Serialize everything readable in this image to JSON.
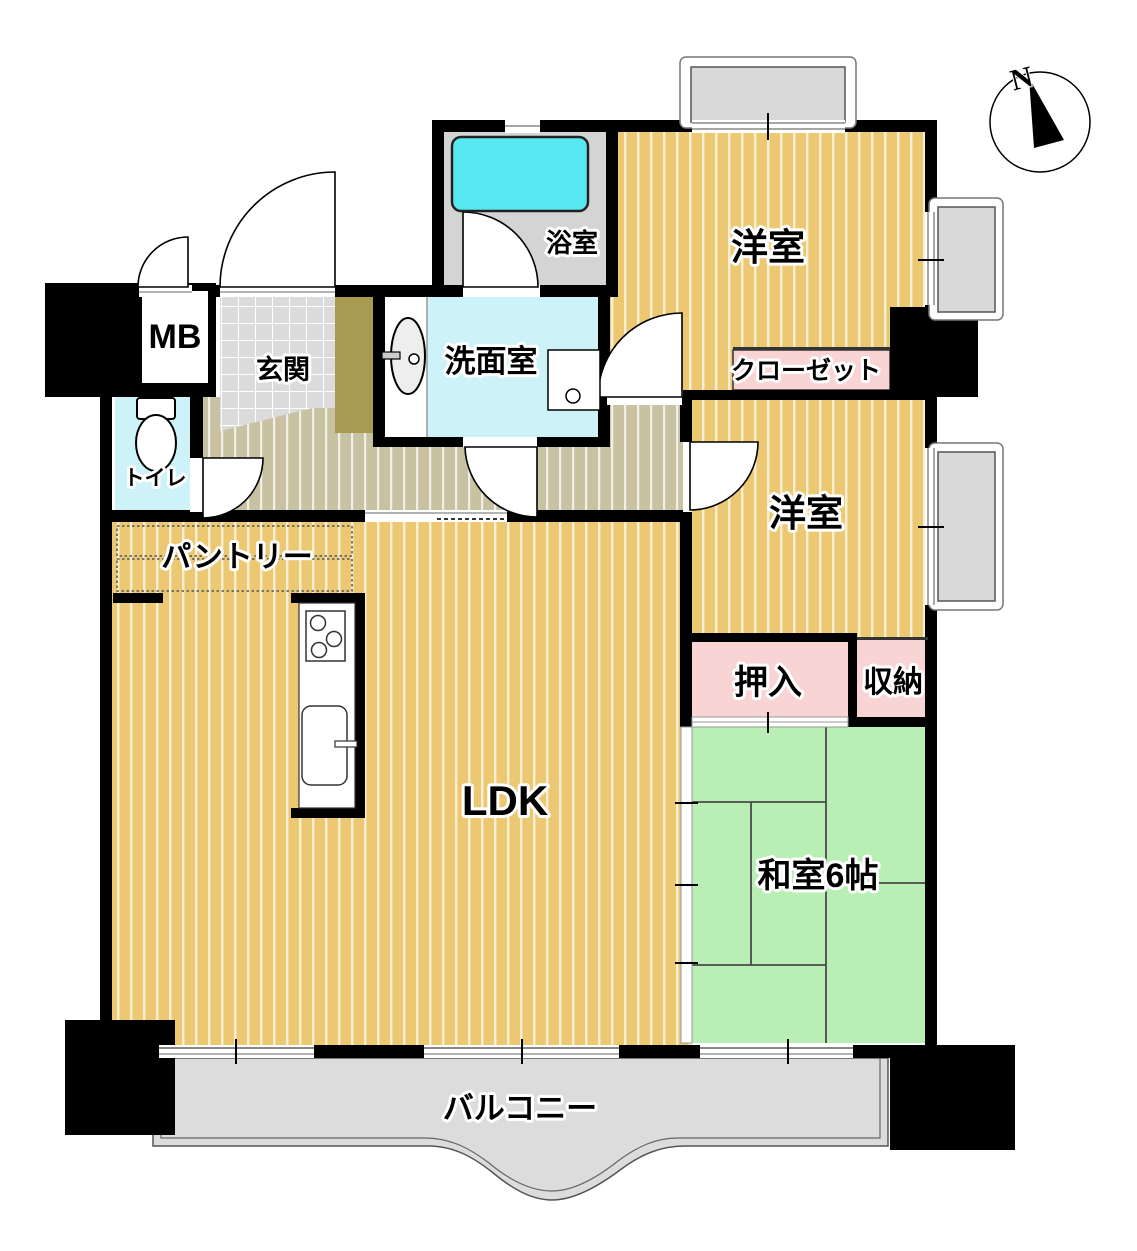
{
  "title": "apartment-floor-plan",
  "compass": {
    "north_label": "N"
  },
  "rooms": [
    {
      "id": "meter-box",
      "label": "MB"
    },
    {
      "id": "entrance",
      "label": "玄関"
    },
    {
      "id": "toilet",
      "label": "トイレ"
    },
    {
      "id": "pantry",
      "label": "パントリー"
    },
    {
      "id": "washroom",
      "label": "洗面室"
    },
    {
      "id": "bathroom",
      "label": "浴室"
    },
    {
      "id": "western-room-1",
      "label": "洋室"
    },
    {
      "id": "closet",
      "label": "クローゼット"
    },
    {
      "id": "western-room-2",
      "label": "洋室"
    },
    {
      "id": "oshiire",
      "label": "押入"
    },
    {
      "id": "storage",
      "label": "収納"
    },
    {
      "id": "japanese-room",
      "label": "和室6帖"
    },
    {
      "id": "ldk",
      "label": "LDK"
    },
    {
      "id": "balcony",
      "label": "バルコニー"
    }
  ],
  "colors": {
    "wood_floor": "#ecc873",
    "hall_floor": "#c9c2a2",
    "entrance_tile": "#dbdbdb",
    "entrance_step": "#a89a50",
    "tatami": "#b9efb5",
    "closet_pink": "#f9d4d4",
    "water_cyan": "#cdf3f8",
    "bathtub_cyan": "#57e7f0",
    "bath_floor": "#d4d4d4",
    "balcony_gray": "#dcdcdc",
    "wall": "#000000"
  }
}
